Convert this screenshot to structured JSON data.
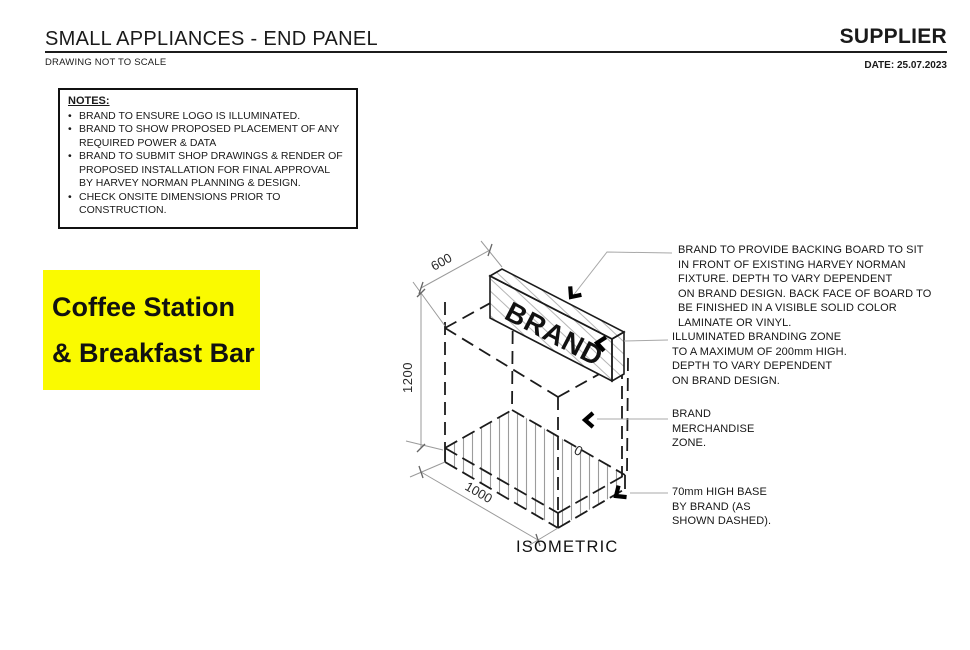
{
  "sheet": {
    "title": "SMALL APPLIANCES - END PANEL",
    "scale_note": "DRAWING NOT TO SCALE",
    "supplier_label": "SUPPLIER",
    "date_label": "DATE: 25.07.2023"
  },
  "notes": {
    "heading": "NOTES:",
    "items": [
      "BRAND TO ENSURE LOGO IS ILLUMINATED.",
      "BRAND TO SHOW PROPOSED PLACEMENT OF ANY REQUIRED POWER & DATA",
      "BRAND TO SUBMIT SHOP DRAWINGS & RENDER OF PROPOSED INSTALLATION FOR FINAL APPROVAL BY HARVEY NORMAN PLANNING & DESIGN.",
      "CHECK ONSITE DIMENSIONS PRIOR TO CONSTRUCTION."
    ]
  },
  "highlight_label": {
    "line1": "Coffee Station",
    "line2": "& Breakfast Bar",
    "background_color": "#FAFA00",
    "text_color": "#111111"
  },
  "drawing": {
    "view_label": "ISOMETRIC",
    "panel_text": "BRAND",
    "dimensions": {
      "depth_mm": "600",
      "height_mm": "1200",
      "width_mm": "1000",
      "partial_digit": "0"
    },
    "annotations": {
      "backing_board": {
        "lines": [
          "BRAND TO PROVIDE BACKING BOARD TO SIT",
          "IN FRONT OF EXISTING HARVEY NORMAN",
          "FIXTURE. DEPTH TO VARY DEPENDENT",
          "ON BRAND DESIGN. BACK FACE OF BOARD TO",
          "BE FINISHED IN A VISIBLE SOLID COLOR",
          "LAMINATE OR VINYL."
        ]
      },
      "illuminated_zone": {
        "lines": [
          "ILLUMINATED BRANDING ZONE",
          "TO A MAXIMUM OF 200mm HIGH.",
          "DEPTH TO VARY DEPENDENT",
          "ON BRAND DESIGN."
        ]
      },
      "merchandise_zone": {
        "lines": [
          "BRAND",
          "MERCHANDISE",
          "ZONE."
        ]
      },
      "base": {
        "lines": [
          "70mm HIGH BASE",
          "BY BRAND (AS",
          "SHOWN DASHED)."
        ]
      }
    },
    "colors": {
      "line_black": "#1b1b1b",
      "dim_gray": "#9a9a9a",
      "hatch_gray": "#b5b5b5"
    }
  }
}
